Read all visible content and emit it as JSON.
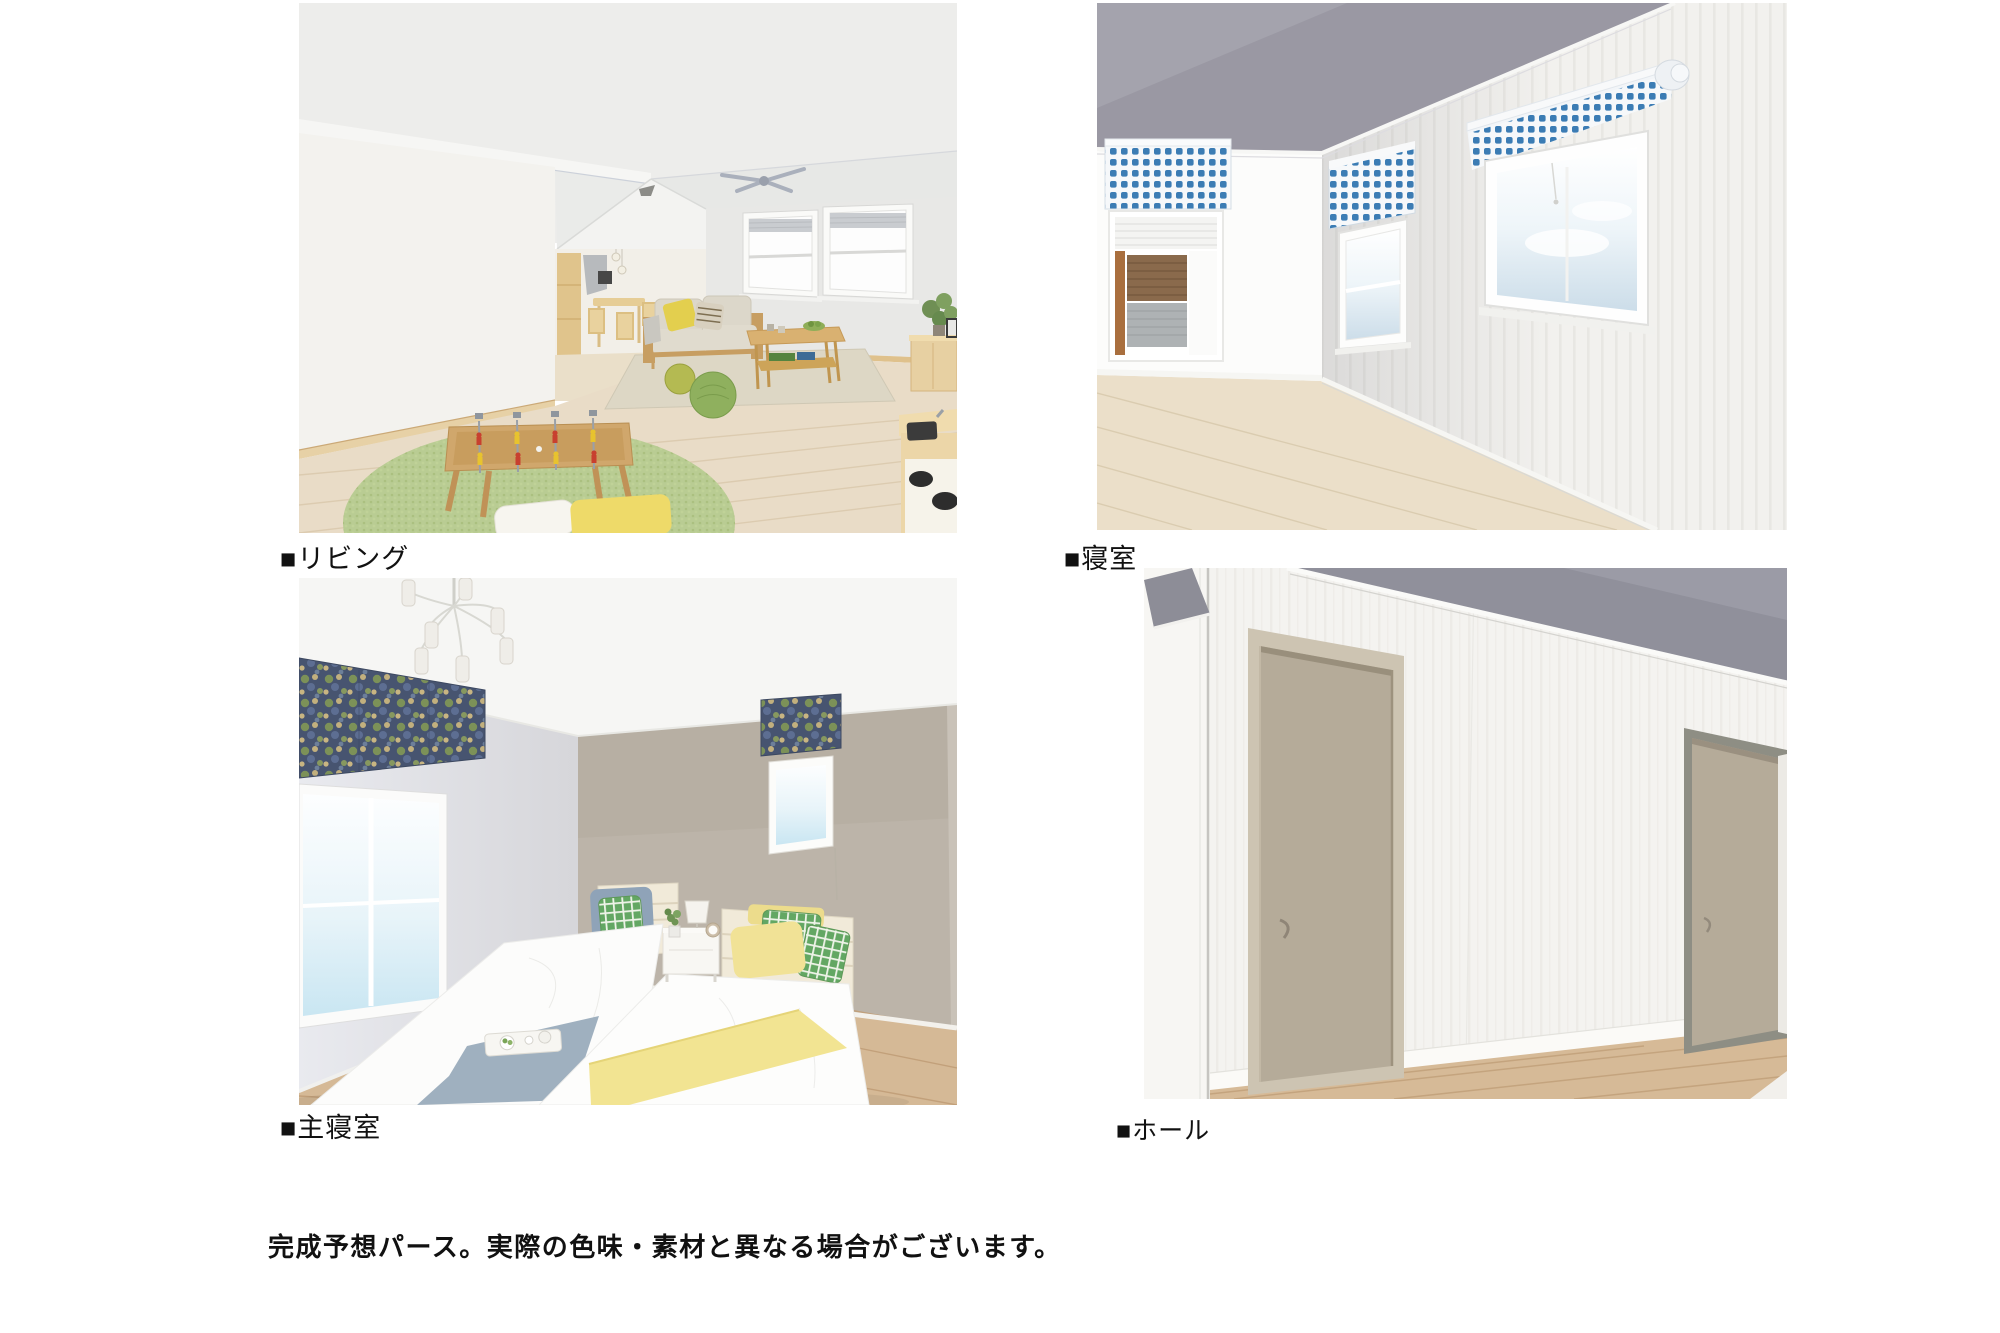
{
  "panels": [
    {
      "id": "living",
      "label": "■リビング",
      "room": "リビング"
    },
    {
      "id": "bedroom",
      "label": "■寝室",
      "room": "寝室"
    },
    {
      "id": "master",
      "label": "■主寝室",
      "room": "主寝室"
    },
    {
      "id": "hall",
      "label": "■ホール",
      "room": "ホール"
    }
  ],
  "caption": "完成予想パース。実際の色味・素材と異なる場合がございます。",
  "palette": {
    "page_bg": "#ffffff",
    "label_color": "#111111",
    "living": {
      "wall": "#f3f2ee",
      "ceiling": "#ededeb",
      "floor": "#e9dcc7",
      "round_rug": "#b9cc93",
      "area_rug": "#ddd7c5",
      "sofa_wood": "#c79e62",
      "cushion_yellow": "#e3cf4e",
      "pouf_green": "#8fb05e"
    },
    "bedroom": {
      "ceiling": "#9a98a3",
      "wall": "#f2f1ee",
      "bright_wall": "#fcfcfb",
      "floor": "#ebdfc9",
      "valance_blue": "#3b7cb4",
      "siding_brown": "#8a6a4c"
    },
    "master": {
      "ceiling": "#f6f6f4",
      "left_wall": "#e7e8ed",
      "accent_wall": "#bcb4a9",
      "floor": "#d5b996",
      "valance_navy": "#475470",
      "pillow_green": "#63a763",
      "throw_yellow": "#f2e492",
      "throw_blue": "#9fb0bf"
    },
    "hall": {
      "wall": "#f4f3f0",
      "ceiling": "#90909b",
      "door": "#b5ab99",
      "floor": "#d6ba97"
    }
  }
}
